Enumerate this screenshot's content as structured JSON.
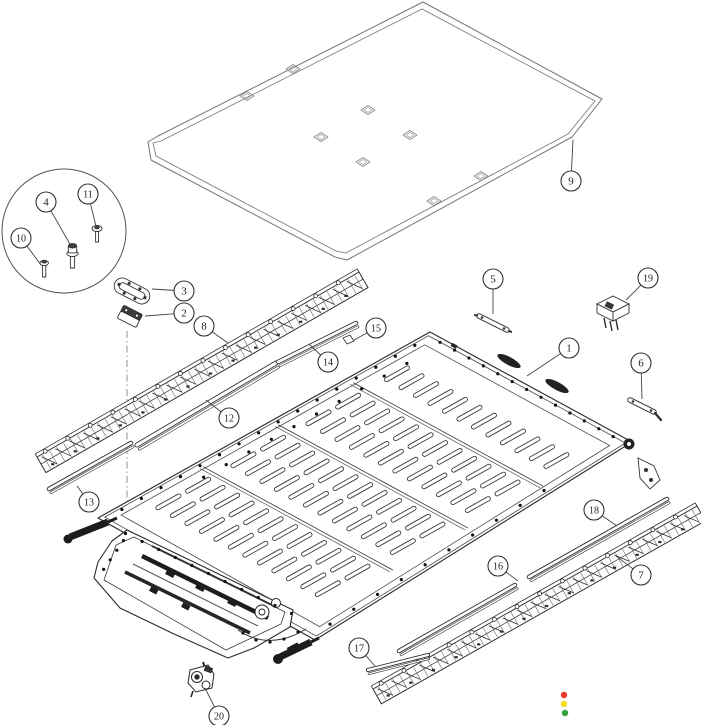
{
  "diagram": {
    "type": "exploded-parts-diagram",
    "background": "#ffffff",
    "line_color": "#2f2f2f",
    "cover_line_color": "#757575",
    "detail_circle": {
      "cx": 64,
      "cy": 231,
      "r": 62
    },
    "callouts": [
      {
        "num": "1",
        "cx": 569,
        "cy": 348,
        "tx": 527,
        "ty": 376
      },
      {
        "num": "2",
        "cx": 184,
        "cy": 313,
        "tx": 145,
        "ty": 316
      },
      {
        "num": "3",
        "cx": 184,
        "cy": 291,
        "tx": 152,
        "ty": 289
      },
      {
        "num": "4",
        "cx": 46,
        "cy": 202,
        "tx": 71,
        "ty": 246
      },
      {
        "num": "5",
        "cx": 493,
        "cy": 279,
        "tx": 493,
        "ty": 314
      },
      {
        "num": "6",
        "cx": 641,
        "cy": 363,
        "tx": 642,
        "ty": 399
      },
      {
        "num": "7",
        "cx": 641,
        "cy": 575,
        "tx": 616,
        "ty": 556
      },
      {
        "num": "8",
        "cx": 204,
        "cy": 326,
        "tx": 228,
        "ty": 343
      },
      {
        "num": "9",
        "cx": 571,
        "cy": 181,
        "tx": 573,
        "ty": 140
      },
      {
        "num": "10",
        "cx": 21,
        "cy": 238,
        "tx": 41,
        "ty": 265
      },
      {
        "num": "11",
        "cx": 88,
        "cy": 194,
        "tx": 96,
        "ty": 226
      },
      {
        "num": "12",
        "cx": 229,
        "cy": 418,
        "tx": 206,
        "ty": 400
      },
      {
        "num": "13",
        "cx": 89,
        "cy": 502,
        "tx": 77,
        "ty": 486
      },
      {
        "num": "14",
        "cx": 328,
        "cy": 362,
        "tx": 309,
        "ty": 344
      },
      {
        "num": "15",
        "cx": 376,
        "cy": 328,
        "tx": 354,
        "ty": 340
      },
      {
        "num": "16",
        "cx": 498,
        "cy": 566,
        "tx": 518,
        "ty": 581
      },
      {
        "num": "17",
        "cx": 359,
        "cy": 648,
        "tx": 375,
        "ty": 666
      },
      {
        "num": "18",
        "cx": 594,
        "cy": 510,
        "tx": 617,
        "ty": 526
      },
      {
        "num": "19",
        "cx": 648,
        "cy": 278,
        "tx": 626,
        "ty": 300
      },
      {
        "num": "20",
        "cx": 219,
        "cy": 716,
        "tx": 206,
        "ty": 690
      }
    ],
    "cover_holes": [
      {
        "cx": 293,
        "cy": 69
      },
      {
        "cx": 247,
        "cy": 96
      },
      {
        "cx": 368,
        "cy": 110
      },
      {
        "cx": 410,
        "cy": 135
      },
      {
        "cx": 321,
        "cy": 137
      },
      {
        "cx": 363,
        "cy": 162
      },
      {
        "cx": 481,
        "cy": 176
      },
      {
        "cx": 434,
        "cy": 201
      }
    ],
    "status_dots": [
      {
        "name": "red",
        "color": "#e8382c",
        "x": 564,
        "y": 695
      },
      {
        "name": "yellow",
        "color": "#f5dd1f",
        "x": 564,
        "y": 704
      },
      {
        "name": "green",
        "color": "#33a23d",
        "x": 565,
        "y": 713
      }
    ]
  }
}
